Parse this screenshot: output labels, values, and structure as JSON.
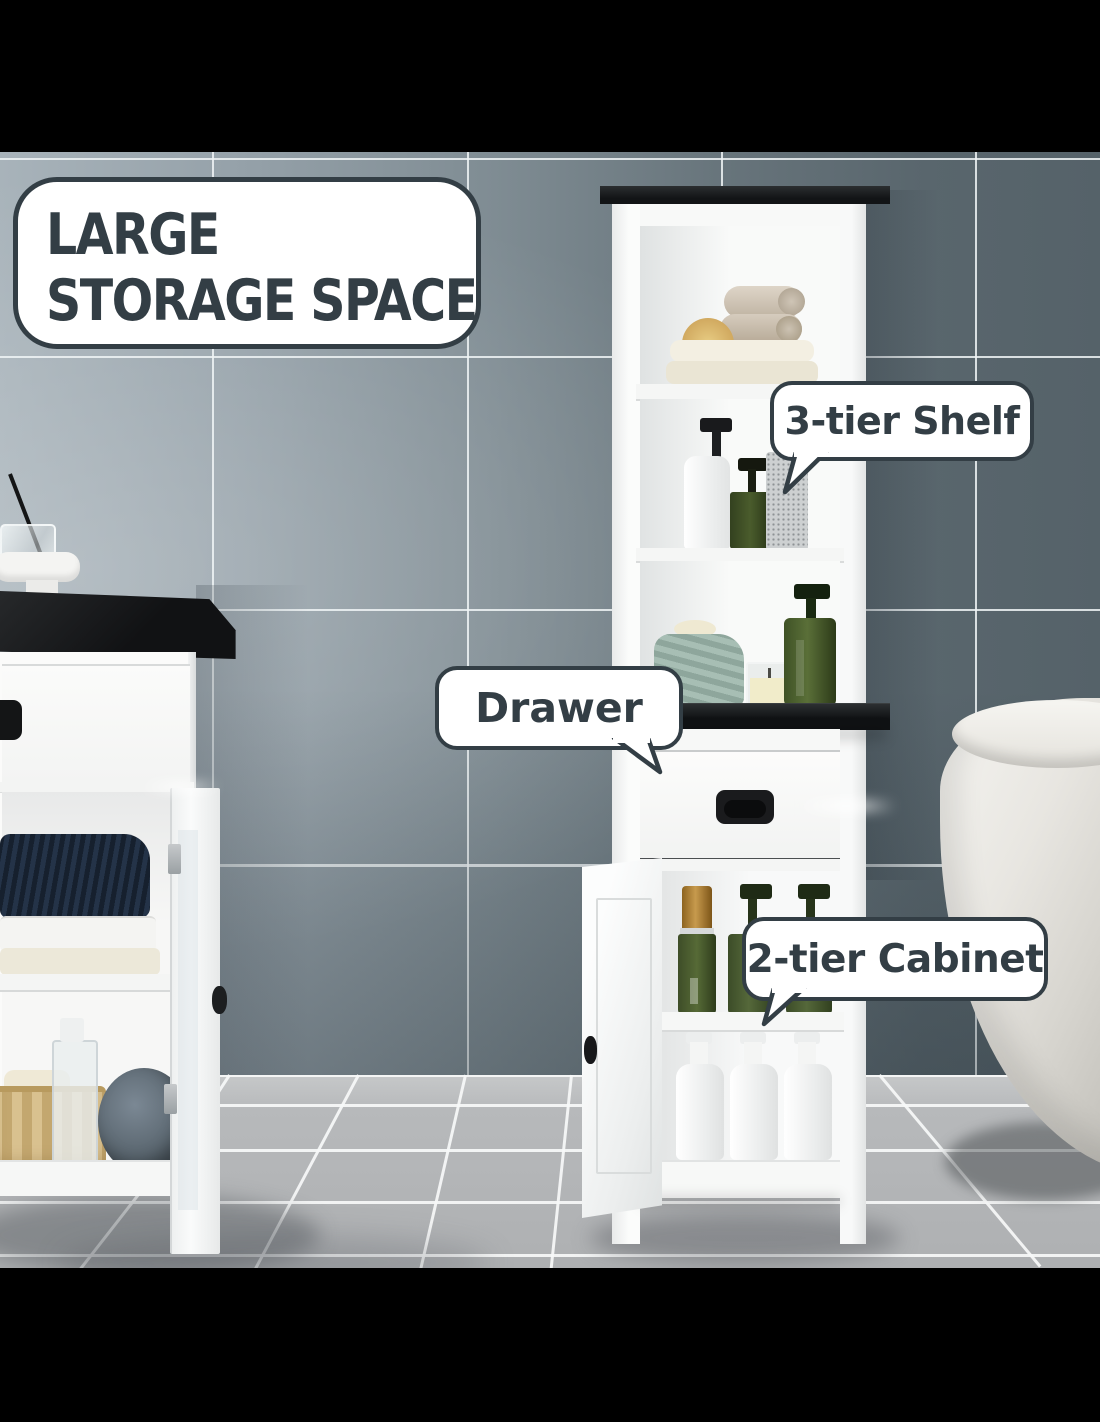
{
  "headline": {
    "label": "LARGE STORAGE SPACE"
  },
  "callouts": {
    "shelf": {
      "label": "3-tier Shelf"
    },
    "drawer": {
      "label": "Drawer"
    },
    "cabinet": {
      "label": "2-tier Cabinet"
    }
  },
  "scene": {
    "setting": "bathroom with blue-gray tiled wall and light gray tiled floor, letterboxed with black bars",
    "products": [
      "tall white linen tower with black top, 3 open shelves, middle drawer and open 2-tier door cabinet",
      "white side cabinet with black top, drawer and open glass door (partially visible at left)",
      "white freestanding bathtub (partially visible at right)"
    ],
    "props": [
      "rolled and folded cream towels",
      "wooden brush",
      "white and green soap dispenser bottles",
      "speckled cup",
      "sage green towel with soap bar",
      "candle in glass",
      "reed diffuser",
      "navy/white/cream towel stack",
      "wicker basket",
      "clear spray bottle",
      "gray loofah",
      "green bottle with gold cap",
      "two green pump bottles",
      "three white pump bottles"
    ]
  },
  "palette": {
    "letterbox": "#000000",
    "callout_bg": "#ffffff",
    "callout_border": "#333e45",
    "callout_text": "#333e45",
    "wall_light": "#a6b1b8",
    "wall_dark": "#56636a",
    "grout": "#eef2f4",
    "floor": "#b7b9bb",
    "furniture_white": "#fbfcfb",
    "furniture_black_top": "#17191b",
    "towel_navy": "#1b2838",
    "towel_sage": "#9ab3a8",
    "bottle_green": "#46572e",
    "bottle_gold": "#b07f2e",
    "tub": "#e7e5e0"
  }
}
